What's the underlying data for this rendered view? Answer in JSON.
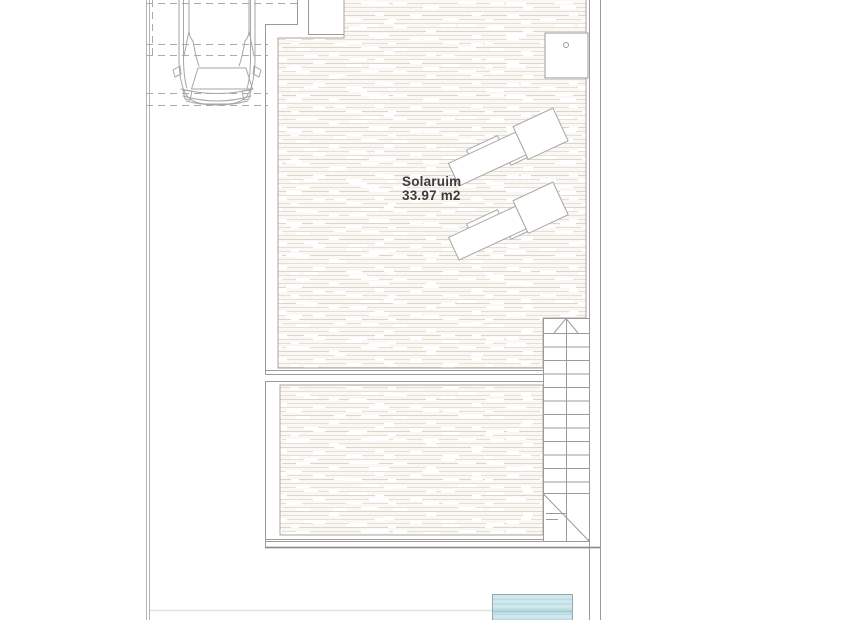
{
  "floor_plan": {
    "room_labels": [
      {
        "name": "Solaruim",
        "area": "33.97 m2"
      }
    ],
    "features": {
      "stairs": {
        "steps": 13,
        "direction_arrow": "up"
      },
      "sun_loungers": {
        "count": 2
      },
      "car_parking_space": {
        "car_present": true
      },
      "pool": {
        "present": true
      },
      "shower_tray": {
        "present": true
      }
    },
    "colors": {
      "deck_base": "#faf8f4",
      "deck_stripe": "#e6dfd4",
      "wall_line": "#9b9b9b",
      "boundary_line": "#b5b5b5",
      "dashed_line": "#aaaaaa",
      "pool_fill": "#cfe7ed",
      "pool_stripe": "#b7d9e1",
      "pool_border": "#93a7ad",
      "label_text": "#3c3c3c"
    }
  }
}
